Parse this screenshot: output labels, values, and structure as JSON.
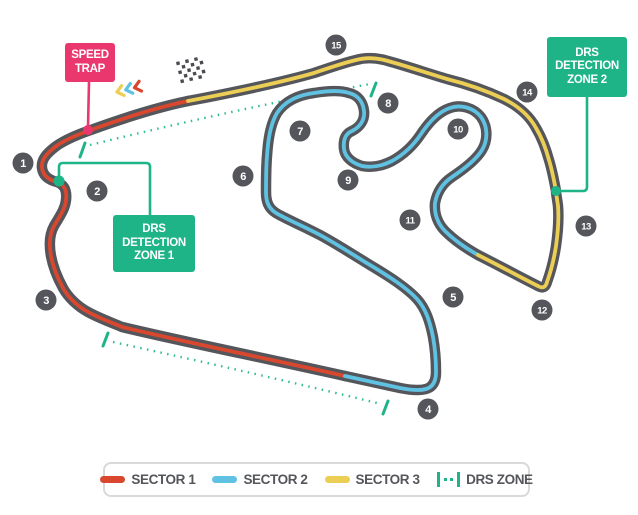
{
  "colors": {
    "track_base": "#54565B",
    "sector1": "#D9472F",
    "sector2": "#5FC2E2",
    "sector3": "#EDCE55",
    "drs_green": "#1EB488",
    "drs_dots": "#2EBC92",
    "speed_trap_pink": "#EA386E",
    "turn_marker": "#54565B",
    "legend_text": "#54565B"
  },
  "speed_trap": {
    "lines": [
      "SPEED",
      "TRAP"
    ]
  },
  "drs_zone_1": {
    "lines": [
      "DRS",
      "DETECTION",
      "ZONE 1"
    ]
  },
  "drs_zone_2": {
    "lines": [
      "DRS",
      "DETECTION",
      "ZONE 2"
    ]
  },
  "turns": [
    {
      "label": "1"
    },
    {
      "label": "2"
    },
    {
      "label": "3"
    },
    {
      "label": "4"
    },
    {
      "label": "5"
    },
    {
      "label": "6"
    },
    {
      "label": "7"
    },
    {
      "label": "8"
    },
    {
      "label": "9"
    },
    {
      "label": "10"
    },
    {
      "label": "11"
    },
    {
      "label": "12"
    },
    {
      "label": "13"
    },
    {
      "label": "14"
    },
    {
      "label": "15"
    }
  ],
  "legend": {
    "items": [
      {
        "label": "SECTOR 1",
        "color": "#D9472F"
      },
      {
        "label": "SECTOR 2",
        "color": "#5FC2E2"
      },
      {
        "label": "SECTOR 3",
        "color": "#EDCE55"
      },
      {
        "label": "DRS ZONE",
        "color": "#1EB488"
      }
    ]
  },
  "icons": {
    "checkered_flag": "start-finish-flag",
    "speed_chevrons": [
      "yellow",
      "blue",
      "red"
    ]
  }
}
